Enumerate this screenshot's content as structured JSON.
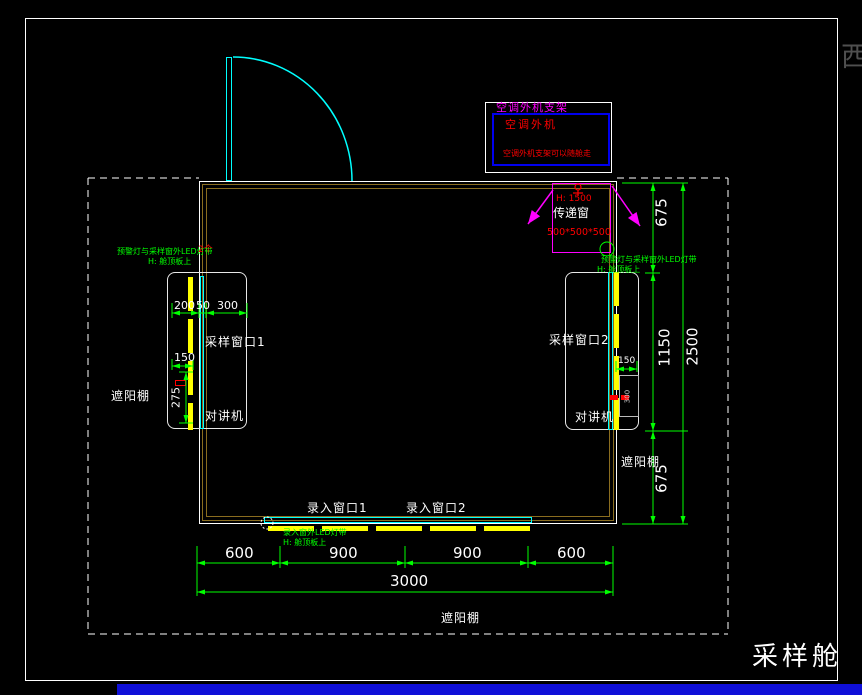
{
  "drawing": {
    "title": "采样舱",
    "edge_char": "西"
  },
  "labels": {
    "sample_window_1": "采样窗口1",
    "sample_window_2": "采样窗口2",
    "intercom_left": "对讲机",
    "intercom_right": "对讲机",
    "entry_window_1": "录入窗口1",
    "entry_window_2": "录入窗口2",
    "transfer_window": "传递窗",
    "canopy_left": "遮阳棚",
    "canopy_right": "遮阳棚",
    "canopy_bottom": "遮阳棚"
  },
  "ac_unit": {
    "bracket": "空调外机支架",
    "unit": "空调外机",
    "note": "空调外机支架可以随舱走"
  },
  "transfer_window": {
    "height": "H: 1500",
    "size": "500*500*500"
  },
  "notes": {
    "side_left": {
      "line1": "预警灯与采样窗外LED灯带",
      "line2": "H: 舱顶板上",
      "qty": "2个"
    },
    "side_right": {
      "line1": "预警灯与采样窗外LED灯带",
      "line2": "H: 舱顶板上"
    },
    "bottom": {
      "line1": "录入窗外LED灯带",
      "line2": "H: 舱顶板上"
    }
  },
  "dims": {
    "bottom": {
      "seg1": "600",
      "seg2": "900",
      "seg3": "900",
      "seg4": "600",
      "total": "3000"
    },
    "right": {
      "seg1": "675",
      "seg2": "1150",
      "seg3": "675",
      "total": "2500"
    },
    "left_window": {
      "a": "200",
      "b": "50",
      "c": "300",
      "d": "150",
      "e": "275"
    },
    "right_window": {
      "a": "150",
      "b": "300"
    }
  },
  "colors": {
    "dimension": "#00ff00",
    "wall_inner": "#8a6d1f",
    "window_glass": "#00ffff",
    "led_strip": "#ffff00",
    "leader": "#ff00ff",
    "alert_text": "#ff0000",
    "ac_box_border": "#0000ee",
    "canopy_dash": "#ffffff",
    "taskbar_blue": "#0f0fd8"
  }
}
